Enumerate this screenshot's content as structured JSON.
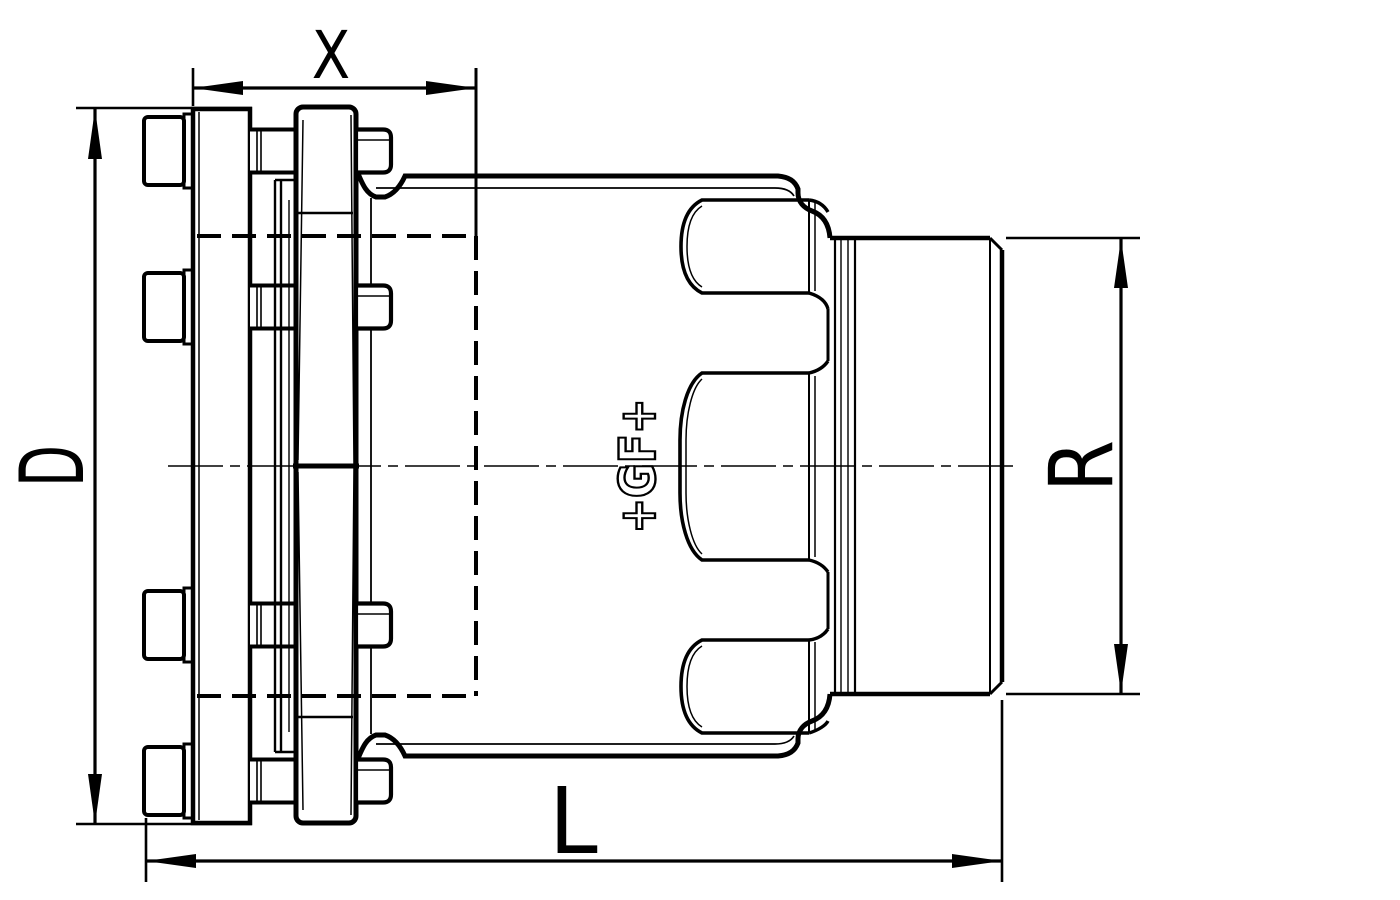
{
  "page": {
    "background": "#ffffff",
    "ink": "#000000",
    "kind": "technical line drawing of a flanged pipe coupling, side section view"
  },
  "drawing": {
    "logo_text": "+GF+",
    "dimension_labels": {
      "top": "X",
      "left": "D",
      "right": "R",
      "bottom": "L"
    },
    "dimensions": [
      {
        "label": "X",
        "axis": "horizontal",
        "location": "top"
      },
      {
        "label": "D",
        "axis": "vertical",
        "location": "left"
      },
      {
        "label": "R",
        "axis": "vertical",
        "location": "right"
      },
      {
        "label": "L",
        "axis": "horizontal",
        "location": "bottom"
      }
    ],
    "line_styles": {
      "visible_edges": "solid",
      "hidden_edges": "dashed",
      "center_line": "dash-dot"
    }
  }
}
